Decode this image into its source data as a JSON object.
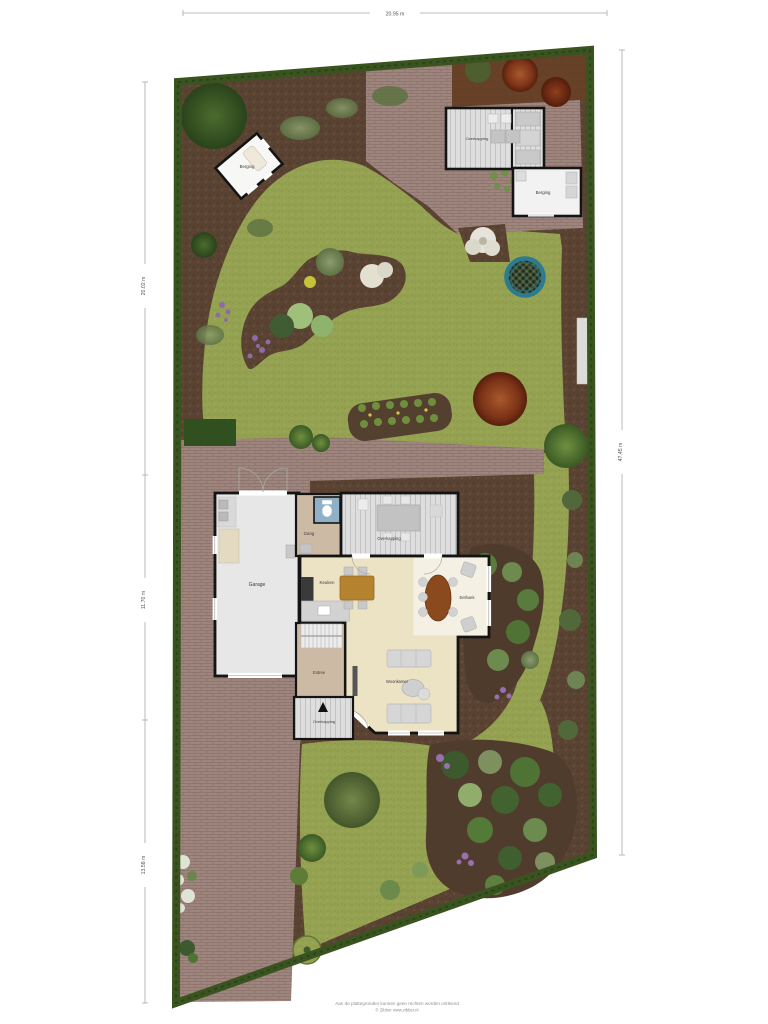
{
  "dimensions": {
    "top": "20.95 m",
    "left_upper": "20.02 m",
    "left_middle": "11.70 m",
    "left_lower": "13.58 m",
    "right": "47.45 m"
  },
  "labels": {
    "garage": "Garage",
    "gang": "Gang",
    "keuken": "Keuken",
    "eethoek": "Eethoek",
    "woonkamer": "Woonkamer",
    "entree": "Entree",
    "overkapping_house": "Overkapping",
    "overkapping_front": "Overkapping",
    "overkapping_garden": "Overkapping",
    "berging_garden_left": "Berging",
    "berging_garden_right": "Berging"
  },
  "disclaimer": {
    "line1": "Aan de plattegronden kunnen geen rechten worden ontleend",
    "line2": "© Zibber www.zibber.nl"
  },
  "colors": {
    "lawn": "#95a252",
    "soil": "#5a4332",
    "brick": "#9e857d",
    "hedge": "#3a5420",
    "wall": "#141414",
    "floor_cream": "#ece2c4",
    "floor_beige": "#cdbaa4",
    "deck": "#dedede",
    "trampoline_ring": "#2c7b90",
    "dimension_line": "#a9a9a9"
  }
}
